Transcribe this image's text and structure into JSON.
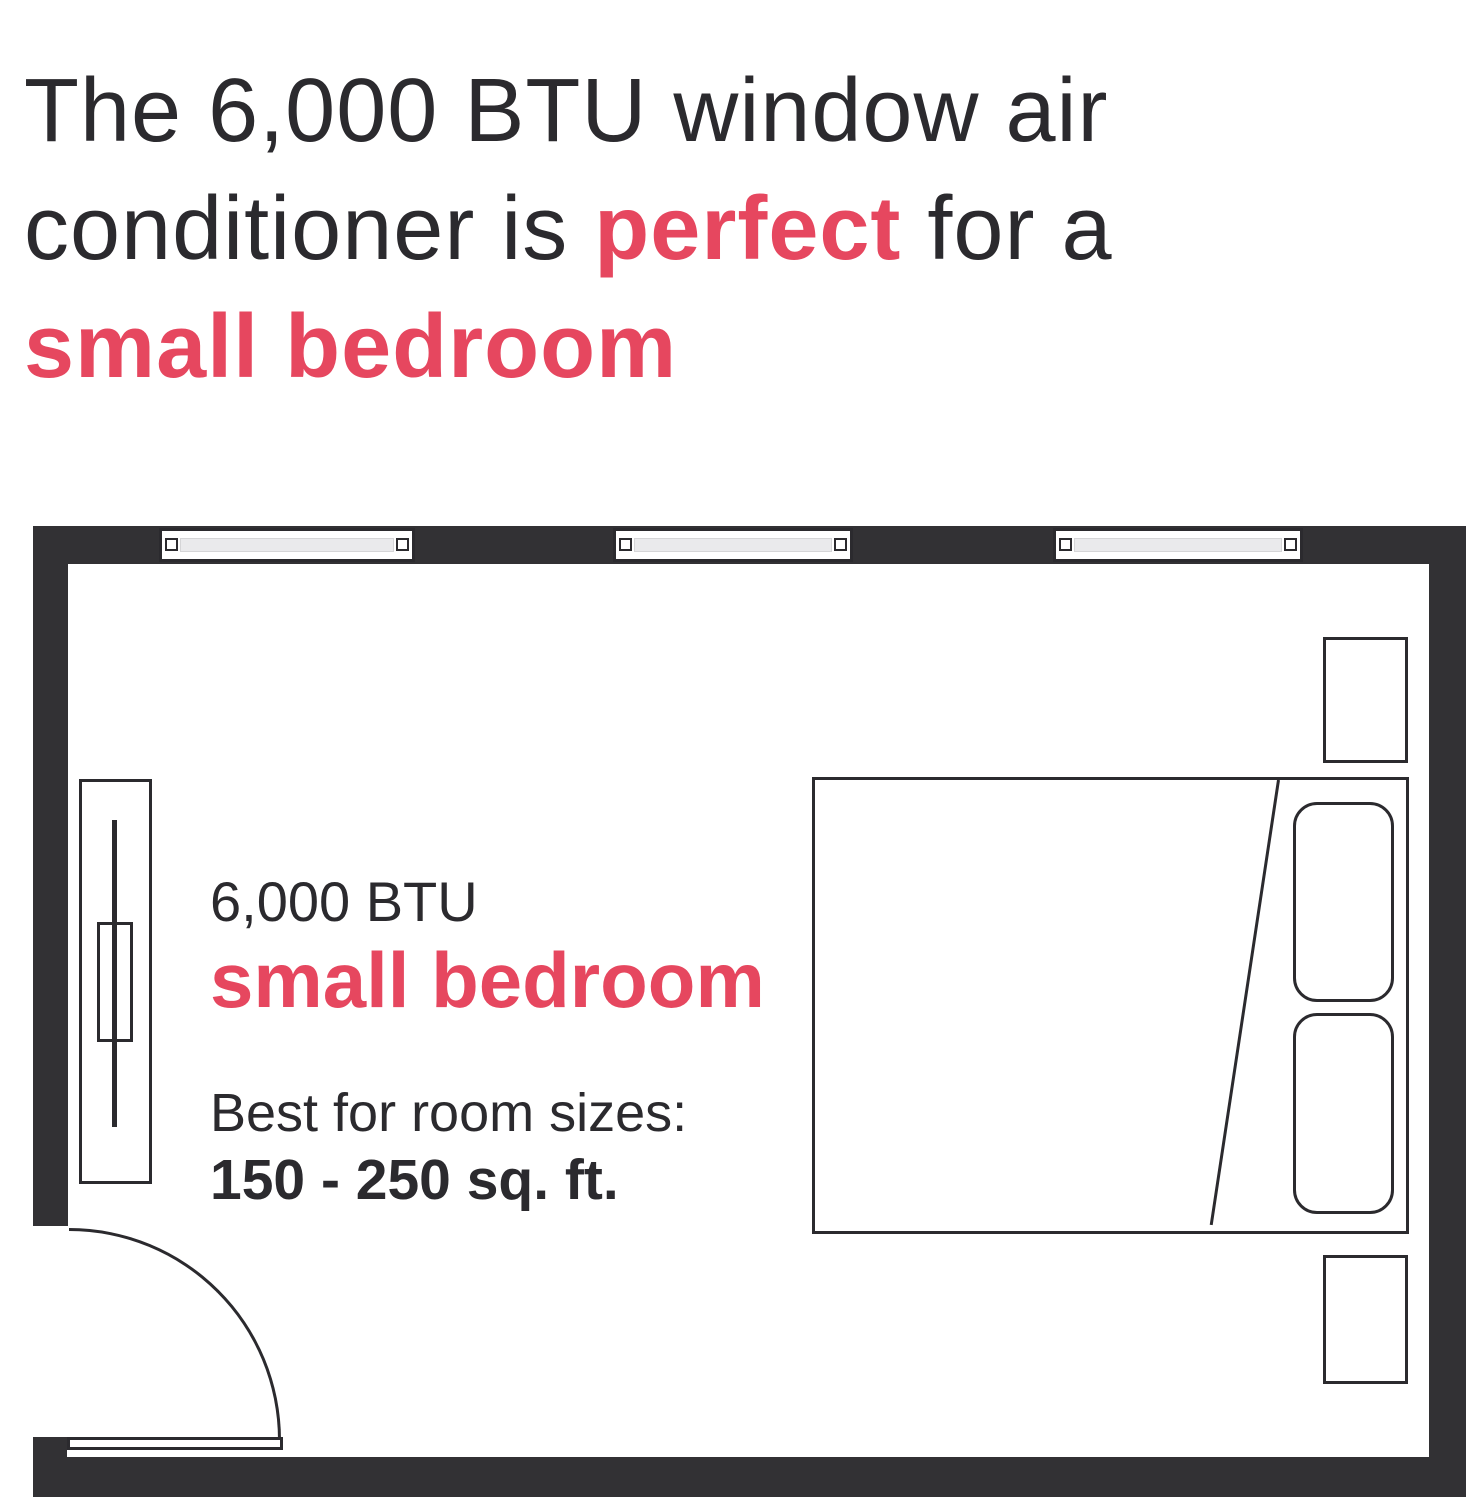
{
  "headline": {
    "line1": "The 6,000 BTU window air",
    "line2_prefix": "conditioner is ",
    "line2_emphasis": "perfect",
    "line2_suffix": " for a",
    "line3_emphasis": "small bedroom"
  },
  "floor_plan_label": {
    "btu": "6,000 BTU",
    "room_type": "small bedroom",
    "best_for": "Best for room sizes:",
    "size_range": "150 - 250 sq. ft."
  },
  "diagram": {
    "type": "bedroom-floor-plan",
    "window_count": 3
  },
  "colors": {
    "accent_red": "#e6475f",
    "text_dark": "#2b2a2e",
    "wall_dark": "#323134",
    "window_glass": "#eaeaec"
  }
}
